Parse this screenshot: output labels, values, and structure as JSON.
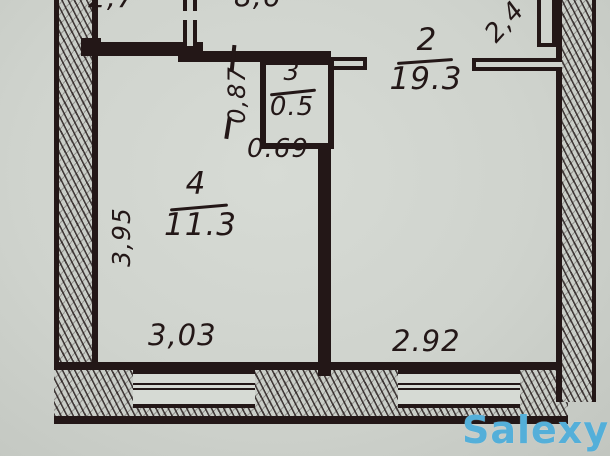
{
  "plan": {
    "rooms": {
      "room2": {
        "number": "2",
        "area": "19.3"
      },
      "room3": {
        "number": "3",
        "area": "0.5"
      },
      "room4": {
        "number": "4",
        "area": "11.3"
      }
    },
    "dimensions": {
      "top_left": "2,7",
      "top_middle": "8,6",
      "top_right": "2,4",
      "closet_depth": "0,87",
      "closet_width": "0.69",
      "room4_height": "3,95",
      "room4_width": "3,03",
      "room2_width": "2.92"
    }
  },
  "watermark": {
    "text": "Salexy",
    "color": "#54afd9"
  },
  "colors": {
    "ink": "#231717",
    "paper": "#cfd3cd"
  }
}
